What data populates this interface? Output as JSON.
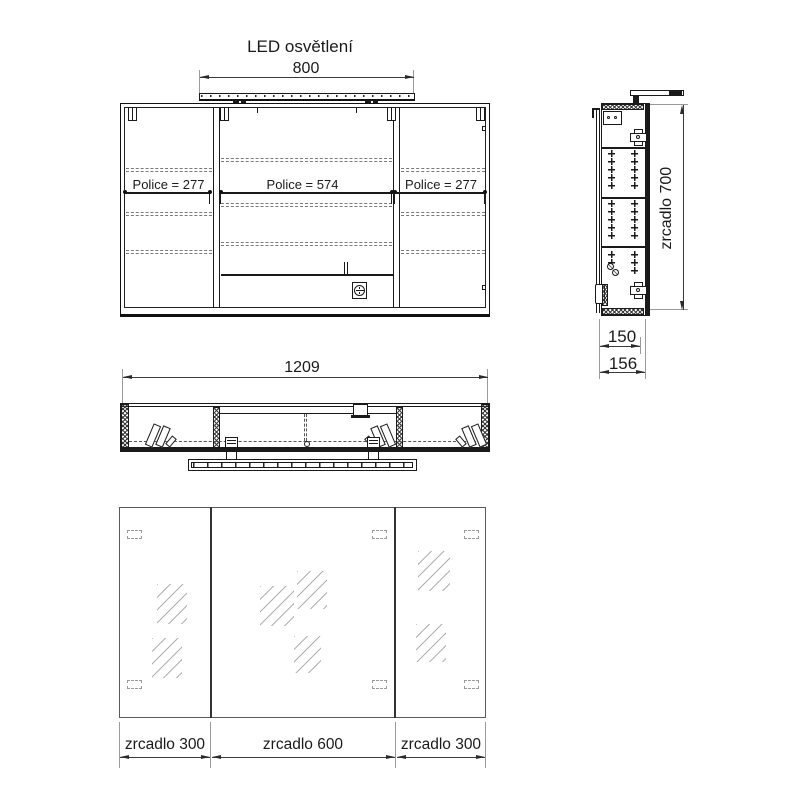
{
  "drawing": {
    "title": "LED osvětlení",
    "front_view": {
      "led_width": "800",
      "police_left": "Police = 277",
      "police_center": "Police = 574",
      "police_right": "Police = 277"
    },
    "side_view": {
      "mirror_height": "zrcadlo 700",
      "body_depth": "150",
      "total_depth": "156"
    },
    "plan_view": {
      "total_width": "1209"
    },
    "mirror_view": {
      "left_panel": "zrcadlo 300",
      "center_panel": "zrcadlo 600",
      "right_panel": "zrcadlo 300"
    },
    "colors": {
      "background": "#ffffff",
      "line": "#1a1a1a",
      "dimension": "#3a3a3a",
      "reflection": "#b0b0b0"
    }
  }
}
